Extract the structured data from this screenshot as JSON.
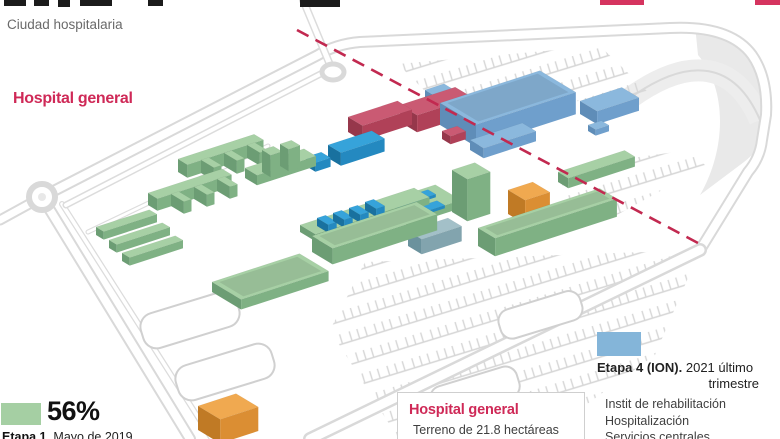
{
  "header": {
    "kicker": "Ciudad hospitalaria"
  },
  "labels": {
    "hospital_general": "Hospital general"
  },
  "legend_etapa1": {
    "value": "56%",
    "stage_bold": "Etapa 1.",
    "stage_rest": " Mayo de 2019",
    "swatch_color": "#a5cfa3"
  },
  "legend_etapa4": {
    "title_bold": "Etapa 4 (ION).",
    "title_rest": " 2021 último",
    "title_line2": "trimestre",
    "swatch_color": "#84b5d9",
    "items": [
      "Instit de rehabilitación",
      "Hospitalización",
      "Servicios centrales"
    ]
  },
  "info_box": {
    "title": "Hospital general",
    "line": "Terreno de 21.8 hectáreas"
  },
  "map": {
    "dashed_line": {
      "color": "#c22950"
    },
    "palette": {
      "green": {
        "top": "#a7d0a5",
        "side": "#7fb184",
        "end": "#6c9d74"
      },
      "lightblue": {
        "top": "#8bb8dd",
        "side": "#6f9fcc",
        "end": "#5f8db8"
      },
      "blue": {
        "top": "#36a3da",
        "side": "#2489c0",
        "end": "#19719f"
      },
      "red": {
        "top": "#ca5a73",
        "side": "#b04158",
        "end": "#96374b"
      },
      "orange": {
        "top": "#f0a950",
        "side": "#db8e33",
        "end": "#c07a25"
      },
      "teal": {
        "top": "#a3c0c8",
        "side": "#82a4ae",
        "end": "#6b929d"
      }
    },
    "buildings": [
      {
        "name": "etapa4-annex-west",
        "c": "lightblue",
        "x": 425,
        "y": 100,
        "w": 20,
        "d": 12,
        "h": 10
      },
      {
        "name": "etapa4-east-building",
        "c": "lightblue",
        "x": 580,
        "y": 114,
        "w": 44,
        "d": 20,
        "h": 13
      },
      {
        "name": "red-building-east",
        "c": "red",
        "x": 400,
        "y": 122,
        "w": 58,
        "d": 20,
        "h": 17
      },
      {
        "name": "etapa4-main-complex",
        "c": "lightblue",
        "x": 440,
        "y": 125,
        "w": 105,
        "d": 42,
        "h": 22,
        "inset": true
      },
      {
        "name": "etapa4-small-annex",
        "c": "lightblue",
        "x": 588,
        "y": 131,
        "w": 14,
        "d": 9,
        "h": 6
      },
      {
        "name": "red-building-west",
        "c": "red",
        "x": 348,
        "y": 132,
        "w": 52,
        "d": 17,
        "h": 15
      },
      {
        "name": "red-annex",
        "c": "red",
        "x": 442,
        "y": 139,
        "w": 16,
        "d": 10,
        "h": 8
      },
      {
        "name": "etapa4-front-annex",
        "c": "lightblue",
        "x": 470,
        "y": 150,
        "w": 55,
        "d": 16,
        "h": 10
      },
      {
        "name": "blue-building-west",
        "c": "blue",
        "x": 328,
        "y": 158,
        "w": 46,
        "d": 15,
        "h": 13
      },
      {
        "name": "blue-small-building",
        "c": "blue",
        "x": 306,
        "y": 166,
        "w": 16,
        "d": 11,
        "h": 9
      },
      {
        "name": "green-comb-north-bar",
        "c": "green",
        "x": 178,
        "y": 172,
        "w": 80,
        "d": 11,
        "h": 13
      },
      {
        "name": "green-comb-north-tooth",
        "c": "green",
        "x": 201,
        "y": 173,
        "w": 8,
        "d": 15,
        "h": 13
      },
      {
        "name": "green-comb-north-tooth",
        "c": "green",
        "x": 224,
        "y": 166,
        "w": 8,
        "d": 15,
        "h": 13
      },
      {
        "name": "green-comb-north-tooth",
        "c": "green",
        "x": 247,
        "y": 158,
        "w": 8,
        "d": 15,
        "h": 13
      },
      {
        "name": "green-mid-slab",
        "c": "green",
        "x": 245,
        "y": 178,
        "w": 62,
        "d": 14,
        "h": 10
      },
      {
        "name": "green-tower-a",
        "c": "green",
        "x": 262,
        "y": 172,
        "w": 12,
        "d": 10,
        "h": 22
      },
      {
        "name": "green-tower-b",
        "c": "green",
        "x": 280,
        "y": 166,
        "w": 12,
        "d": 10,
        "h": 22
      },
      {
        "name": "green-east-bar",
        "c": "green",
        "x": 558,
        "y": 182,
        "w": 70,
        "d": 12,
        "h": 10
      },
      {
        "name": "green-comb-south-bar",
        "c": "green",
        "x": 148,
        "y": 205,
        "w": 78,
        "d": 11,
        "h": 12
      },
      {
        "name": "green-comb-south-tooth",
        "c": "green",
        "x": 171,
        "y": 206,
        "w": 8,
        "d": 15,
        "h": 12
      },
      {
        "name": "green-comb-south-tooth",
        "c": "green",
        "x": 194,
        "y": 199,
        "w": 8,
        "d": 15,
        "h": 12
      },
      {
        "name": "green-comb-south-tooth",
        "c": "green",
        "x": 217,
        "y": 191,
        "w": 8,
        "d": 15,
        "h": 12
      },
      {
        "name": "green-platform",
        "c": "green",
        "x": 382,
        "y": 210,
        "w": 56,
        "d": 30,
        "h": 8
      },
      {
        "name": "blue-roof-panel",
        "c": "blue",
        "x": 390,
        "y": 205,
        "w": 40,
        "d": 9,
        "h": 3
      },
      {
        "name": "blue-roof-panel",
        "c": "blue",
        "x": 399,
        "y": 216,
        "w": 40,
        "d": 9,
        "h": 3
      },
      {
        "name": "green-tall-tower",
        "c": "green",
        "x": 452,
        "y": 212,
        "w": 24,
        "d": 18,
        "h": 42
      },
      {
        "name": "orange-building-east",
        "c": "orange",
        "x": 508,
        "y": 214,
        "w": 26,
        "d": 20,
        "h": 24
      },
      {
        "name": "green-spine",
        "c": "green",
        "x": 300,
        "y": 232,
        "w": 120,
        "d": 18,
        "h": 7
      },
      {
        "name": "blue-comb-module",
        "c": "blue",
        "x": 317,
        "y": 226,
        "w": 9,
        "d": 13,
        "h": 8
      },
      {
        "name": "blue-comb-module",
        "c": "blue",
        "x": 333,
        "y": 221,
        "w": 9,
        "d": 13,
        "h": 8
      },
      {
        "name": "blue-comb-module",
        "c": "blue",
        "x": 349,
        "y": 216,
        "w": 9,
        "d": 13,
        "h": 8
      },
      {
        "name": "blue-comb-module",
        "c": "blue",
        "x": 365,
        "y": 210,
        "w": 9,
        "d": 13,
        "h": 8
      },
      {
        "name": "green-strip",
        "c": "green",
        "x": 96,
        "y": 235,
        "w": 56,
        "d": 9,
        "h": 8
      },
      {
        "name": "green-strip",
        "c": "green",
        "x": 109,
        "y": 248,
        "w": 56,
        "d": 9,
        "h": 8
      },
      {
        "name": "green-strip",
        "c": "green",
        "x": 122,
        "y": 261,
        "w": 56,
        "d": 9,
        "h": 8
      },
      {
        "name": "teal-building",
        "c": "teal",
        "x": 408,
        "y": 246,
        "w": 42,
        "d": 16,
        "h": 15
      },
      {
        "name": "green-east-long",
        "c": "green",
        "x": 478,
        "y": 246,
        "w": 128,
        "d": 20,
        "h": 18,
        "inset": true
      },
      {
        "name": "green-south-long",
        "c": "green",
        "x": 312,
        "y": 252,
        "w": 110,
        "d": 24,
        "h": 16,
        "inset": true
      },
      {
        "name": "green-flat-courtyard",
        "c": "green",
        "x": 212,
        "y": 292,
        "w": 92,
        "d": 34,
        "h": 10,
        "inset": true
      },
      {
        "name": "orange-building-south",
        "c": "orange",
        "x": 198,
        "y": 430,
        "w": 40,
        "d": 26,
        "h": 24
      }
    ]
  }
}
